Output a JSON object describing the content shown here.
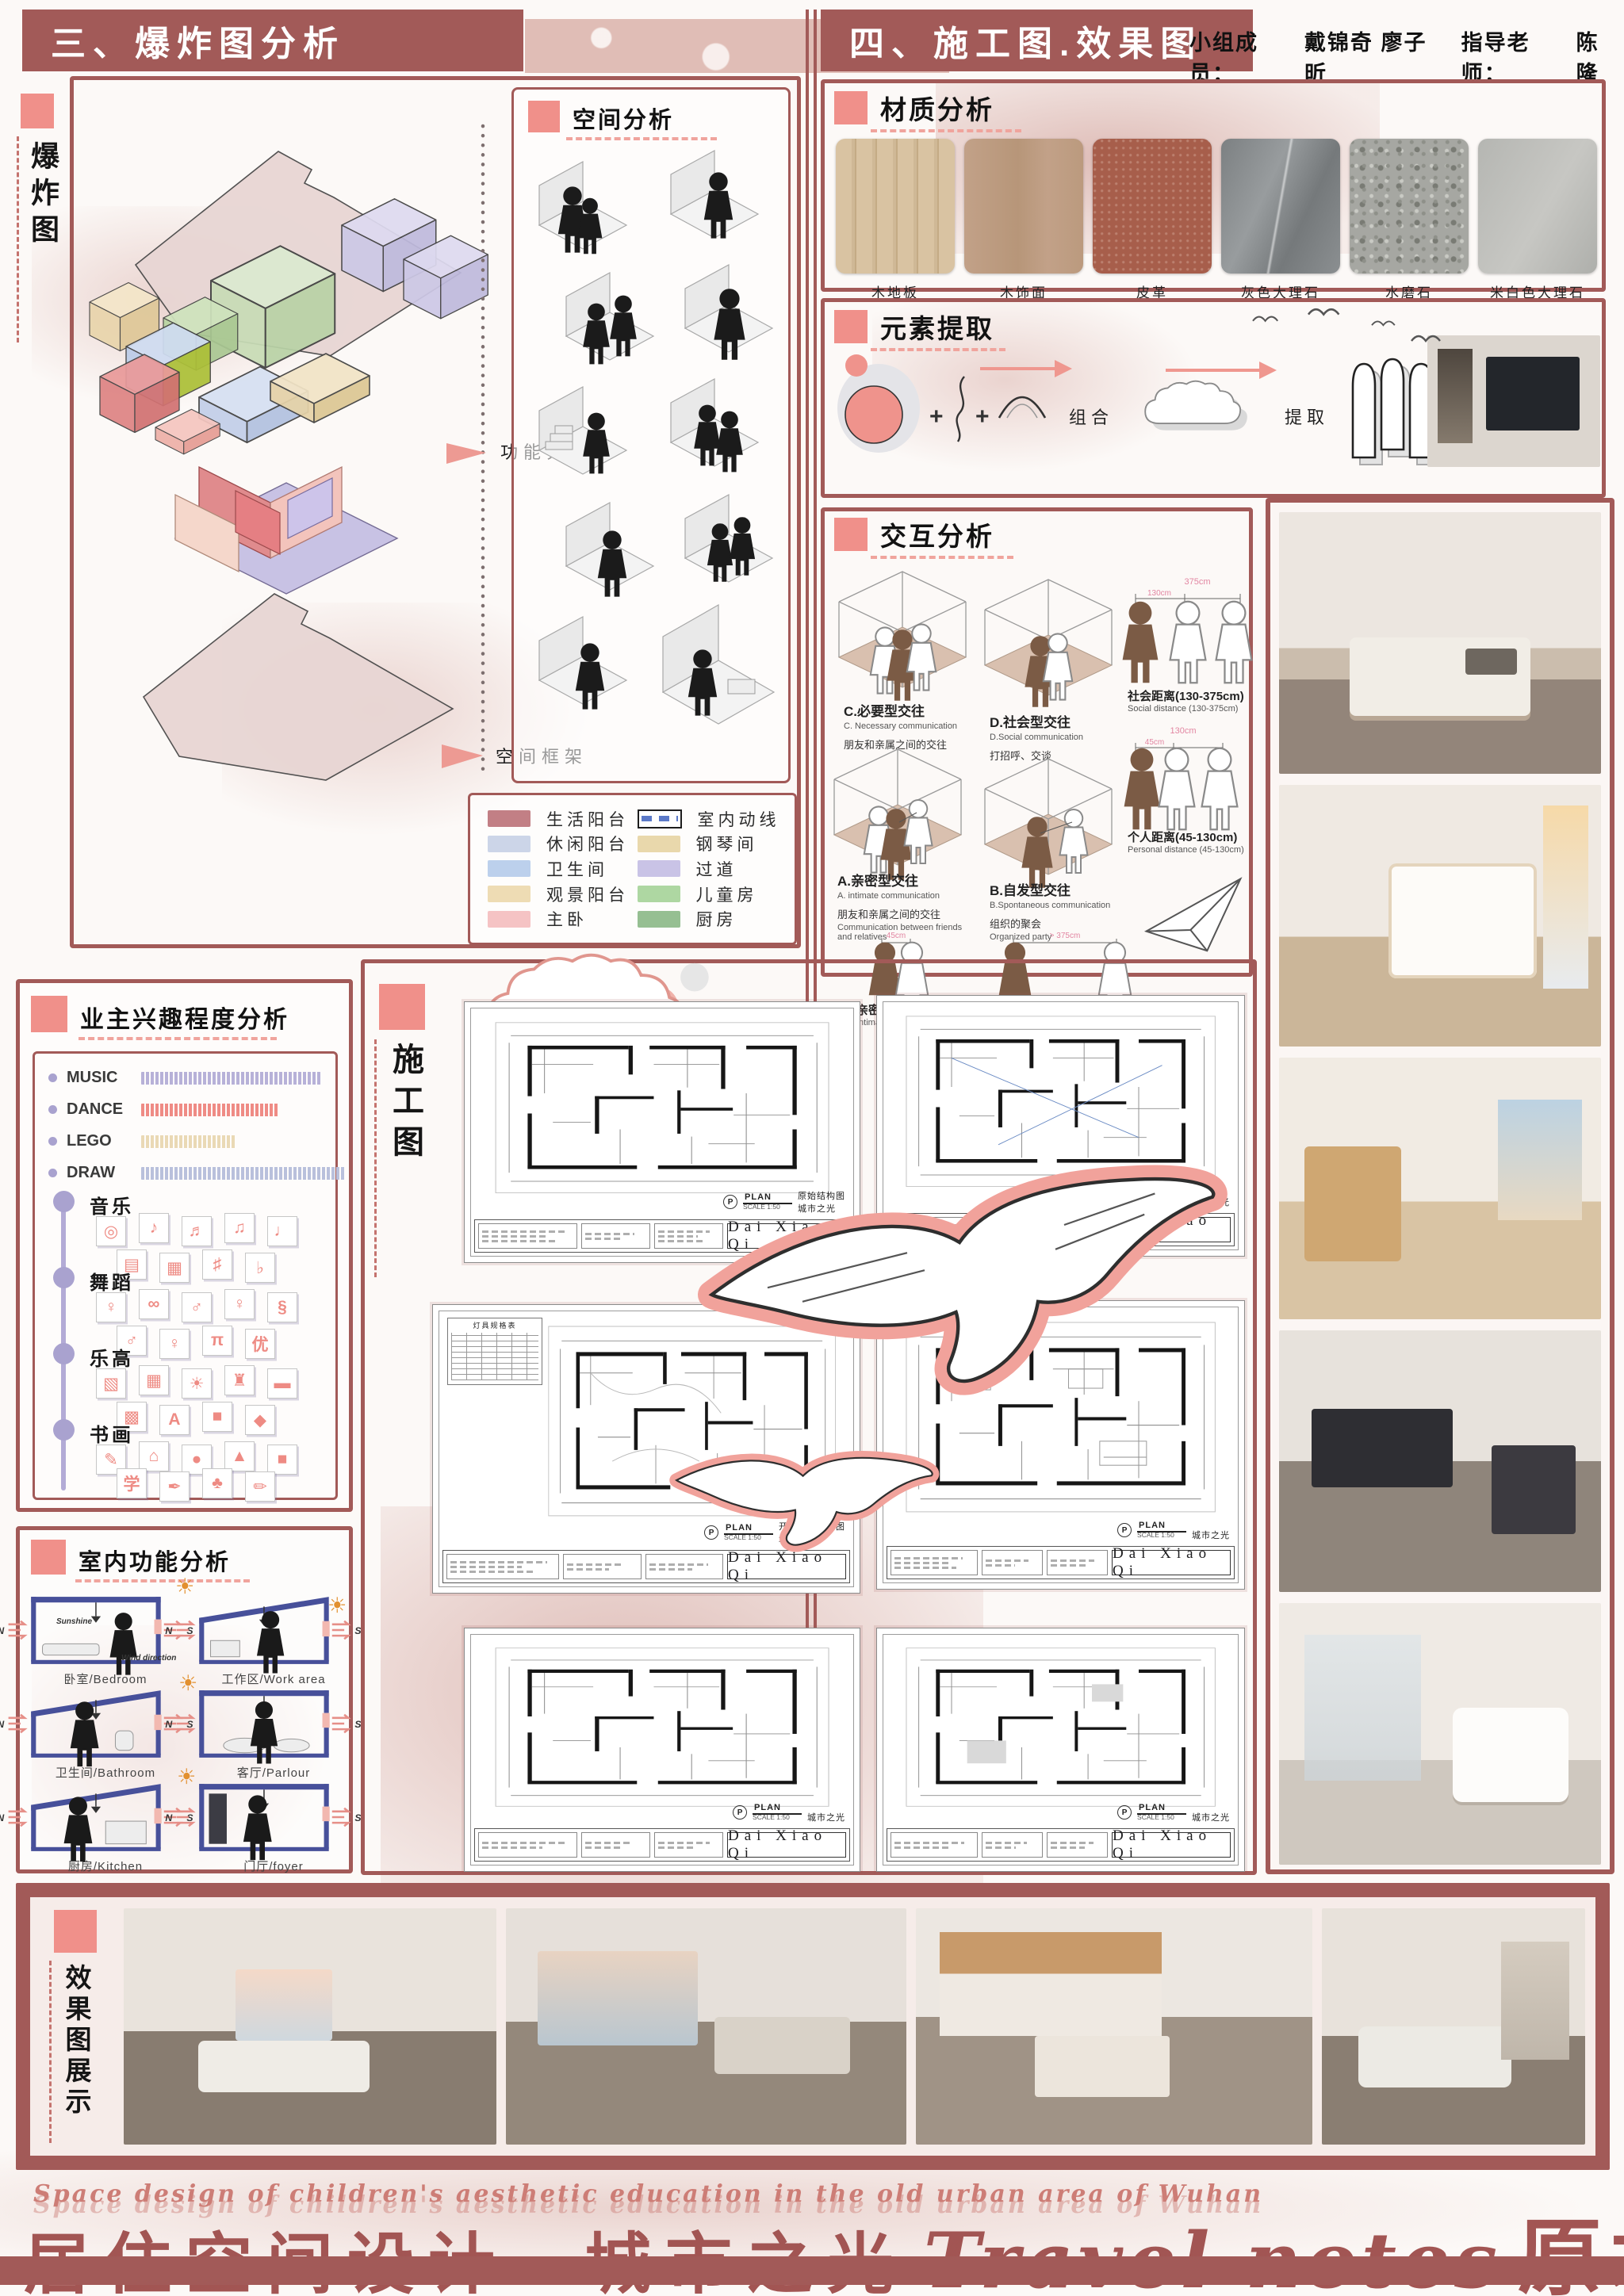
{
  "palette": {
    "rose": "#a25a58",
    "salmon": "#f0908a",
    "ink": "#1d1d1f",
    "lavender": "#a9a2cf"
  },
  "header_left": "三、爆炸图分析",
  "header_right": "四、施工图.效果图",
  "team": {
    "members_label": "小组成员：",
    "members": "戴锦奇  廖子昕",
    "advisor_label": "指导老师：",
    "advisor": "陈隆"
  },
  "exploded": {
    "side_label": "爆炸图",
    "anno_zoning": "功能分区",
    "anno_frame": "空间框架",
    "space_analysis_title": "空间分析",
    "legend": [
      {
        "label": "生活阳台",
        "color": "#c27f85"
      },
      {
        "label": "休闲阳台",
        "color": "#ccd5e8"
      },
      {
        "label": "卫生间",
        "color": "#bcd0ec"
      },
      {
        "label": "观景阳台",
        "color": "#eedcb4"
      },
      {
        "label": "主卧",
        "color": "#f5c3c4"
      },
      {
        "label": "室内动线",
        "icon": "route-dashes"
      },
      {
        "label": "钢琴间",
        "color": "#e9d8ac"
      },
      {
        "label": "过道",
        "color": "#c9c3e6"
      },
      {
        "label": "儿童房",
        "color": "#aed7a2"
      },
      {
        "label": "厨房",
        "color": "#96bf92"
      }
    ]
  },
  "materials": {
    "title": "材质分析",
    "items": [
      "木地板",
      "木饰面",
      "皮革",
      "灰色大理石",
      "水磨石",
      "米白色大理石"
    ]
  },
  "elements": {
    "title": "元素提取",
    "plus": "+",
    "step1": "组合",
    "step2": "提取",
    "result": "电视背景墙"
  },
  "interaction": {
    "title": "交互分析",
    "c": {
      "zh": "C.必要型交往",
      "en": "C. Necessary communication",
      "desc": "朋友和亲属之间的交往"
    },
    "d": {
      "zh": "D.社会型交往",
      "en": "D.Social communication",
      "desc": "打招呼、交谈"
    },
    "a": {
      "zh": "A.亲密型交往",
      "en": "A. intimate communication",
      "desc": "朋友和亲属之间的交往",
      "desc_en": "Communication between friends and relatives"
    },
    "b": {
      "zh": "B.自发型交往",
      "en": "B.Spontaneous communication",
      "desc": "组织的聚会",
      "desc_en": "Organized party"
    },
    "social": {
      "zh": "社会距离(130-375cm)",
      "en": "Social distance (130-375cm)",
      "far": "375cm",
      "near": "130cm"
    },
    "personal": {
      "zh": "个人距离(45-130cm)",
      "en": "Personal distance (45-130cm)",
      "far": "130cm",
      "near": "45cm"
    },
    "intimate": {
      "zh": "亲密距离(0-45cm)",
      "en": "Intimate distance (0-45cm)",
      "near": "45cm"
    },
    "public": {
      "zh": "公众距离大于375cm",
      "en": "Public distance greater than 375cm",
      "far": "> 375cm"
    }
  },
  "interest": {
    "title": "业主兴趣程度分析",
    "bars": [
      {
        "label": "MUSIC",
        "count": 38,
        "color": "#b7b1d8"
      },
      {
        "label": "DANCE",
        "count": 29,
        "color": "#ef8b85"
      },
      {
        "label": "LEGO",
        "count": 20,
        "color": "#ead9b5"
      },
      {
        "label": "DRAW",
        "count": 43,
        "color": "#b9c0dc"
      }
    ],
    "categories": [
      {
        "label": "音乐",
        "icons": [
          "◎",
          "♪",
          "♬",
          "♫",
          "♩",
          "▤",
          "▦",
          "♯",
          "♭"
        ]
      },
      {
        "label": "舞蹈",
        "icons": [
          "♀",
          "∞",
          "♂",
          "♀",
          "§",
          "♂",
          "♀",
          "π",
          "优"
        ]
      },
      {
        "label": "乐高",
        "icons": [
          "▧",
          "▦",
          "☀",
          "♜",
          "▬",
          "▩",
          "A",
          "■",
          "◆"
        ]
      },
      {
        "label": "书画",
        "icons": [
          "✎",
          "⌂",
          "●",
          "▲",
          "■",
          "学",
          "✒",
          "♣",
          "✏"
        ]
      }
    ]
  },
  "functions": {
    "title": "室内功能分析",
    "north": "N",
    "south": "S",
    "sun": "☀",
    "sunshine": "Sunshine",
    "wind": "Wind direction",
    "rooms": [
      "卧室/Bedroom",
      "工作区/Work area",
      "卫生间/Bathroom",
      "客厅/Parlour",
      "厨房/Kitchen",
      "门厅/foyer"
    ]
  },
  "plans": {
    "side_label": "施工图",
    "sheets": [
      {
        "plan": "PLAN",
        "scale": "SCALE 1:50",
        "title": "原始结构图",
        "project": "城市之光",
        "designer": "Dai Xiao Qi"
      },
      {
        "plan": "PLAN",
        "scale": "SCALE 1:50",
        "title": "",
        "project": "城市之光",
        "designer": "Dai Xiao Qi"
      },
      {
        "plan": "PLAN",
        "scale": "SCALE 1:50",
        "title": "开关连线示意图",
        "project": "城市之光",
        "designer": "Dai Xiao Qi",
        "table": "灯具规格表"
      },
      {
        "plan": "PLAN",
        "scale": "SCALE 1:50",
        "title": "",
        "project": "城市之光",
        "designer": "Dai Xiao Qi"
      },
      {
        "plan": "PLAN",
        "scale": "SCALE 1:50",
        "title": "",
        "project": "城市之光",
        "designer": "Dai Xiao Qi"
      },
      {
        "plan": "PLAN",
        "scale": "SCALE 1:50",
        "title": "",
        "project": "城市之光",
        "designer": "Dai Xiao Qi"
      }
    ]
  },
  "renders": {
    "side_label": "效果图展示"
  },
  "footer": {
    "tagline": "Space design of children's aesthetic education in the old urban area of Wuhan",
    "title_zh": "居住空间设计",
    "dash": "—",
    "title_zh2": "城市之光",
    "title_en": "Travel notes",
    "title_zh3": "原木圆"
  }
}
